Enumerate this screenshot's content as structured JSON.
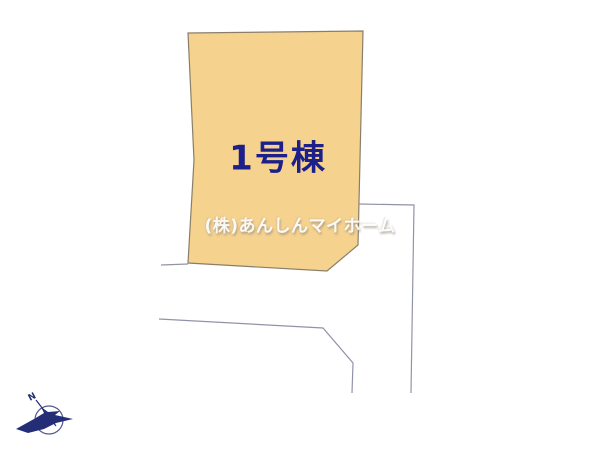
{
  "page": {
    "background": "#ffffff",
    "width": 600,
    "height": 449
  },
  "colors": {
    "parcel_fill": "#F6D28F",
    "parcel_stroke": "#8A7E6A",
    "road_line": "#9193A8",
    "label_navy": "#1D2088",
    "compass_navy": "#232E77"
  },
  "site_plan": {
    "parcel": {
      "label": "1号棟",
      "points": "188,33 363,31 358,245 327,271 188,263 194,160"
    },
    "boundary_lines": [
      {
        "points": "161,265 188,264"
      },
      {
        "points": "159,319 323,328 353,363 352,393"
      },
      {
        "points": "359,204 414,205 411,393"
      }
    ]
  },
  "watermark": {
    "text": "(株)あんしんマイホーム"
  },
  "compass": {
    "icon": "north-compass-bird-arrow",
    "north_label": "N"
  }
}
